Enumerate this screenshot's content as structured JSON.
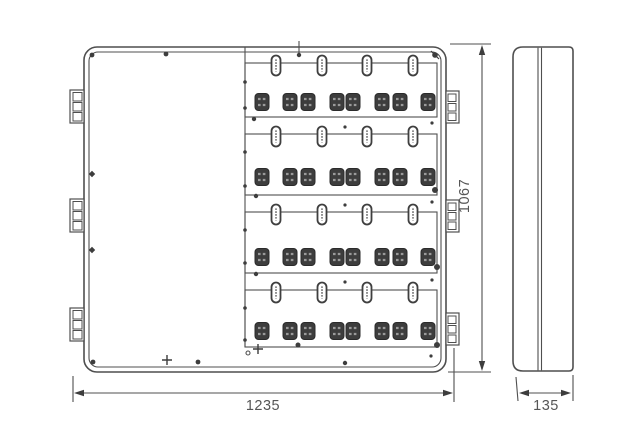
{
  "drawing": {
    "type": "technical-orthographic-drawing",
    "dimensions": {
      "width_label": "1235",
      "height_label": "1067",
      "depth_label": "135"
    },
    "front_view": {
      "meter_rows": 4,
      "viewing_slots_per_row": 4,
      "terminal_blocks_per_row": 8,
      "hinges_left": 3,
      "latches_right": 3
    },
    "side_view": {
      "door_seam_lines": 2
    },
    "colors": {
      "line": "#4f4f4f",
      "terminal_fill": "#3d3d3d",
      "dimension_text": "#565656",
      "background": "#ffffff"
    }
  }
}
